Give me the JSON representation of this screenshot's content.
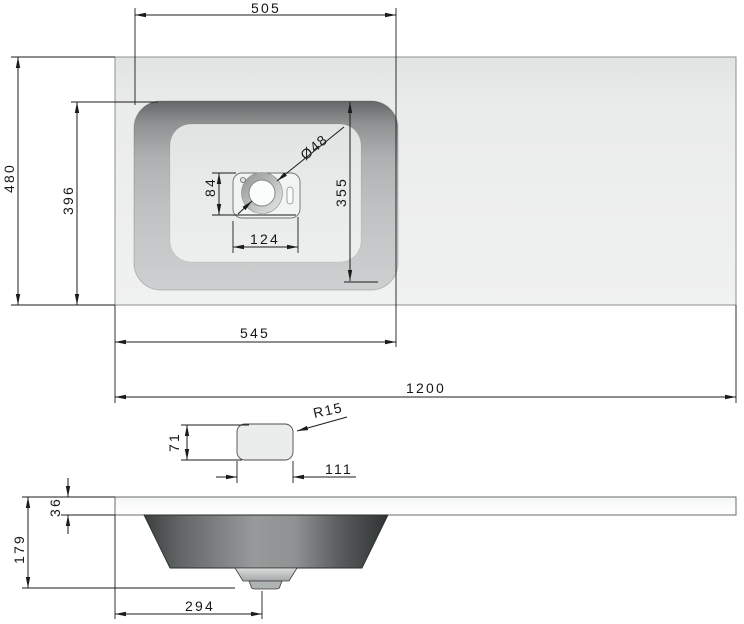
{
  "drawing_type": "washbasin-countertop-technical-drawing",
  "colors": {
    "line": "#1b1b1b",
    "countertop": "#edeeee",
    "basin_wall_dark": "#686b6b",
    "basin_floor": "#e8eaea",
    "bowl_dark": "#3e4141",
    "slab_white": "#fbfcfc"
  },
  "top_view": {
    "basin_opening_width": "505",
    "countertop_depth": "480",
    "basin_outer_depth": "396",
    "basin_inner_depth": "355",
    "faucet_plate_offset": "84",
    "faucet_hole_diameter": "Ø48",
    "faucet_plate_width": "124",
    "basin_zone_width": "545",
    "countertop_width": "1200"
  },
  "detail_view": {
    "plate_height": "71",
    "plate_width": "111",
    "corner_radius": "R15"
  },
  "side_view": {
    "slab_thickness": "36",
    "overall_height": "179",
    "drain_offset": "294"
  }
}
